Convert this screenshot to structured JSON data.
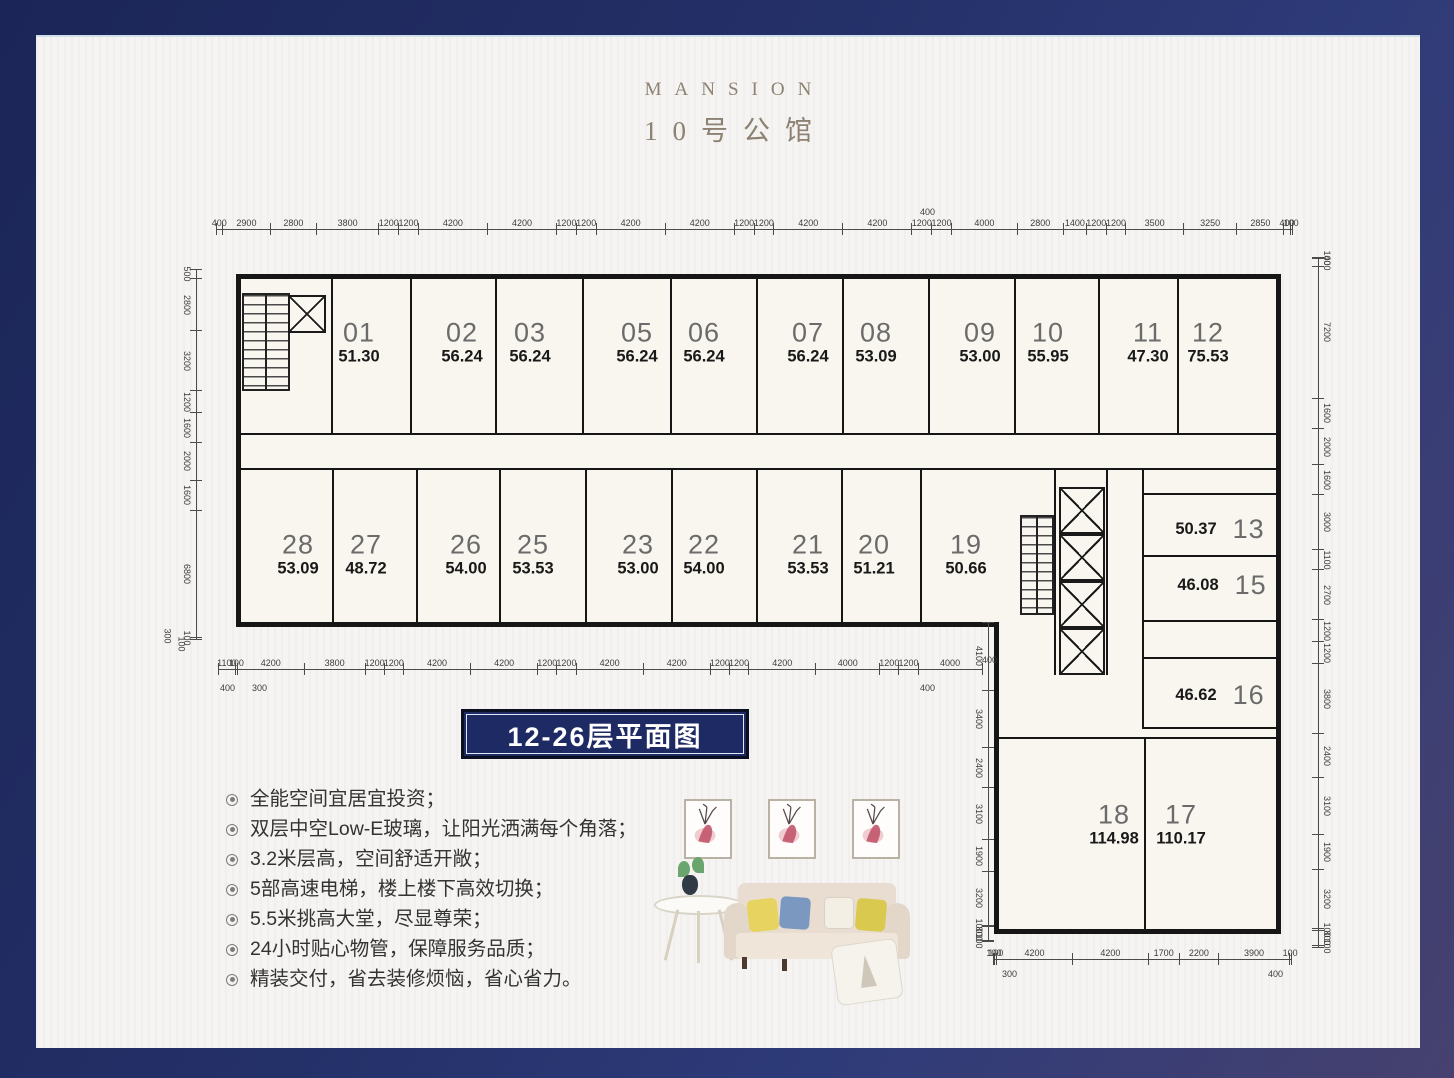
{
  "brand": {
    "title_en": "MANSION",
    "title_cn": "10号公馆"
  },
  "floor_label": "12-26层平面图",
  "features": {
    "items": [
      "全能空间宜居宜投资；",
      "双层中空Low-E玻璃，让阳光洒满每个角落；",
      "3.2米层高，空间舒适开敞；",
      "5部高速电梯，楼上楼下高效切换；",
      "5.5米挑高大堂，尽显尊荣；",
      "24小时贴心物管，保障服务品质；",
      "精装交付，省去装修烦恼，省心省力。"
    ]
  },
  "colors": {
    "frame_navy": "#243068",
    "badge_navy": "#1d2a63",
    "paper": "#f5f4f2",
    "title_taupe": "#8d8171"
  },
  "floor_plan": {
    "units": [
      {
        "no": "01",
        "area": "51.30",
        "cx": 323,
        "cy": 306
      },
      {
        "no": "02",
        "area": "56.24",
        "cx": 426,
        "cy": 306
      },
      {
        "no": "03",
        "area": "56.24",
        "cx": 494,
        "cy": 306
      },
      {
        "no": "05",
        "area": "56.24",
        "cx": 601,
        "cy": 306
      },
      {
        "no": "06",
        "area": "56.24",
        "cx": 668,
        "cy": 306
      },
      {
        "no": "07",
        "area": "56.24",
        "cx": 772,
        "cy": 306
      },
      {
        "no": "08",
        "area": "53.09",
        "cx": 840,
        "cy": 306
      },
      {
        "no": "09",
        "area": "53.00",
        "cx": 944,
        "cy": 306
      },
      {
        "no": "10",
        "area": "55.95",
        "cx": 1012,
        "cy": 306
      },
      {
        "no": "11",
        "area": "47.30",
        "cx": 1112,
        "cy": 306
      },
      {
        "no": "12",
        "area": "75.53",
        "cx": 1172,
        "cy": 306
      },
      {
        "no": "28",
        "area": "53.09",
        "cx": 262,
        "cy": 518
      },
      {
        "no": "27",
        "area": "48.72",
        "cx": 330,
        "cy": 518
      },
      {
        "no": "26",
        "area": "54.00",
        "cx": 430,
        "cy": 518
      },
      {
        "no": "25",
        "area": "53.53",
        "cx": 497,
        "cy": 518
      },
      {
        "no": "23",
        "area": "53.00",
        "cx": 602,
        "cy": 518
      },
      {
        "no": "22",
        "area": "54.00",
        "cx": 668,
        "cy": 518
      },
      {
        "no": "21",
        "area": "53.53",
        "cx": 772,
        "cy": 518
      },
      {
        "no": "20",
        "area": "51.21",
        "cx": 838,
        "cy": 518
      },
      {
        "no": "19",
        "area": "50.66",
        "cx": 930,
        "cy": 518
      },
      {
        "no": "13",
        "area": "50.37",
        "cx": 1184,
        "cy": 492,
        "layout": "row"
      },
      {
        "no": "15",
        "area": "46.08",
        "cx": 1186,
        "cy": 548,
        "layout": "row"
      },
      {
        "no": "16",
        "area": "46.62",
        "cx": 1184,
        "cy": 658,
        "layout": "row"
      },
      {
        "no": "18",
        "area": "114.98",
        "cx": 1078,
        "cy": 788
      },
      {
        "no": "17",
        "area": "110.17",
        "cx": 1145,
        "cy": 788
      }
    ],
    "dimensions": [
      {
        "id": "top",
        "orient": "h",
        "variant": "",
        "x": 180,
        "y": 180,
        "length": 1076,
        "labels": [
          "400",
          "2900",
          "2800",
          "3800",
          "1200",
          "1200",
          "4200",
          "4200",
          "1200",
          "1200",
          "4200",
          "4200",
          "1200",
          "1200",
          "4200",
          "4200",
          "1200",
          "1200",
          "4000",
          "2800",
          "1400",
          "1200",
          "1200",
          "3500",
          "3250",
          "2850",
          "400",
          "100"
        ]
      },
      {
        "id": "left",
        "orient": "v",
        "variant": "labels-left",
        "x": 146,
        "y": 232,
        "length": 370,
        "labels": [
          "500",
          "2800",
          "3200",
          "1200",
          "1600",
          "2000",
          "1600",
          "6800",
          "100"
        ]
      },
      {
        "id": "right",
        "orient": "v",
        "variant": "labels-right",
        "x": 1276,
        "y": 220,
        "length": 690,
        "labels": [
          "100",
          "400",
          "7200",
          "1600",
          "2000",
          "1600",
          "3000",
          "1100",
          "2700",
          "1200",
          "1200",
          "3800",
          "2400",
          "3100",
          "1900",
          "3200",
          "100",
          "800",
          "100"
        ]
      },
      {
        "id": "bottom",
        "orient": "h",
        "variant": "",
        "x": 182,
        "y": 620,
        "length": 764,
        "labels": [
          "1100",
          "100",
          "4200",
          "3800",
          "1200",
          "1200",
          "4200",
          "4200",
          "1200",
          "1200",
          "4200",
          "4200",
          "1200",
          "1200",
          "4200",
          "4000",
          "1200",
          "1200",
          "4000"
        ]
      },
      {
        "id": "mid-vertical",
        "orient": "v",
        "variant": "labels-left",
        "x": 938,
        "y": 585,
        "length": 320,
        "labels": [
          "4100",
          "3400",
          "2400",
          "3100",
          "1900",
          "3200",
          "100",
          "800",
          "100"
        ]
      },
      {
        "id": "wing-bottom",
        "orient": "h",
        "variant": "",
        "x": 957,
        "y": 910,
        "length": 298,
        "labels": [
          "100",
          "100",
          "4200",
          "4200",
          "1700",
          "2200",
          "3900",
          "100"
        ]
      }
    ],
    "dim_annotations": [
      {
        "text": "400",
        "x": 884,
        "y": 170,
        "rot": 0
      },
      {
        "text": "300",
        "x": 124,
        "y": 594,
        "rot": 90
      },
      {
        "text": "100",
        "x": 138,
        "y": 602,
        "rot": 90
      },
      {
        "text": "400",
        "x": 184,
        "y": 646,
        "rot": 0
      },
      {
        "text": "300",
        "x": 216,
        "y": 646,
        "rot": 0
      },
      {
        "text": "400",
        "x": 884,
        "y": 646,
        "rot": 0
      },
      {
        "text": "400",
        "x": 946,
        "y": 618,
        "rot": 0
      },
      {
        "text": "300",
        "x": 966,
        "y": 932,
        "rot": 0
      },
      {
        "text": "400",
        "x": 1232,
        "y": 932,
        "rot": 0
      }
    ]
  }
}
